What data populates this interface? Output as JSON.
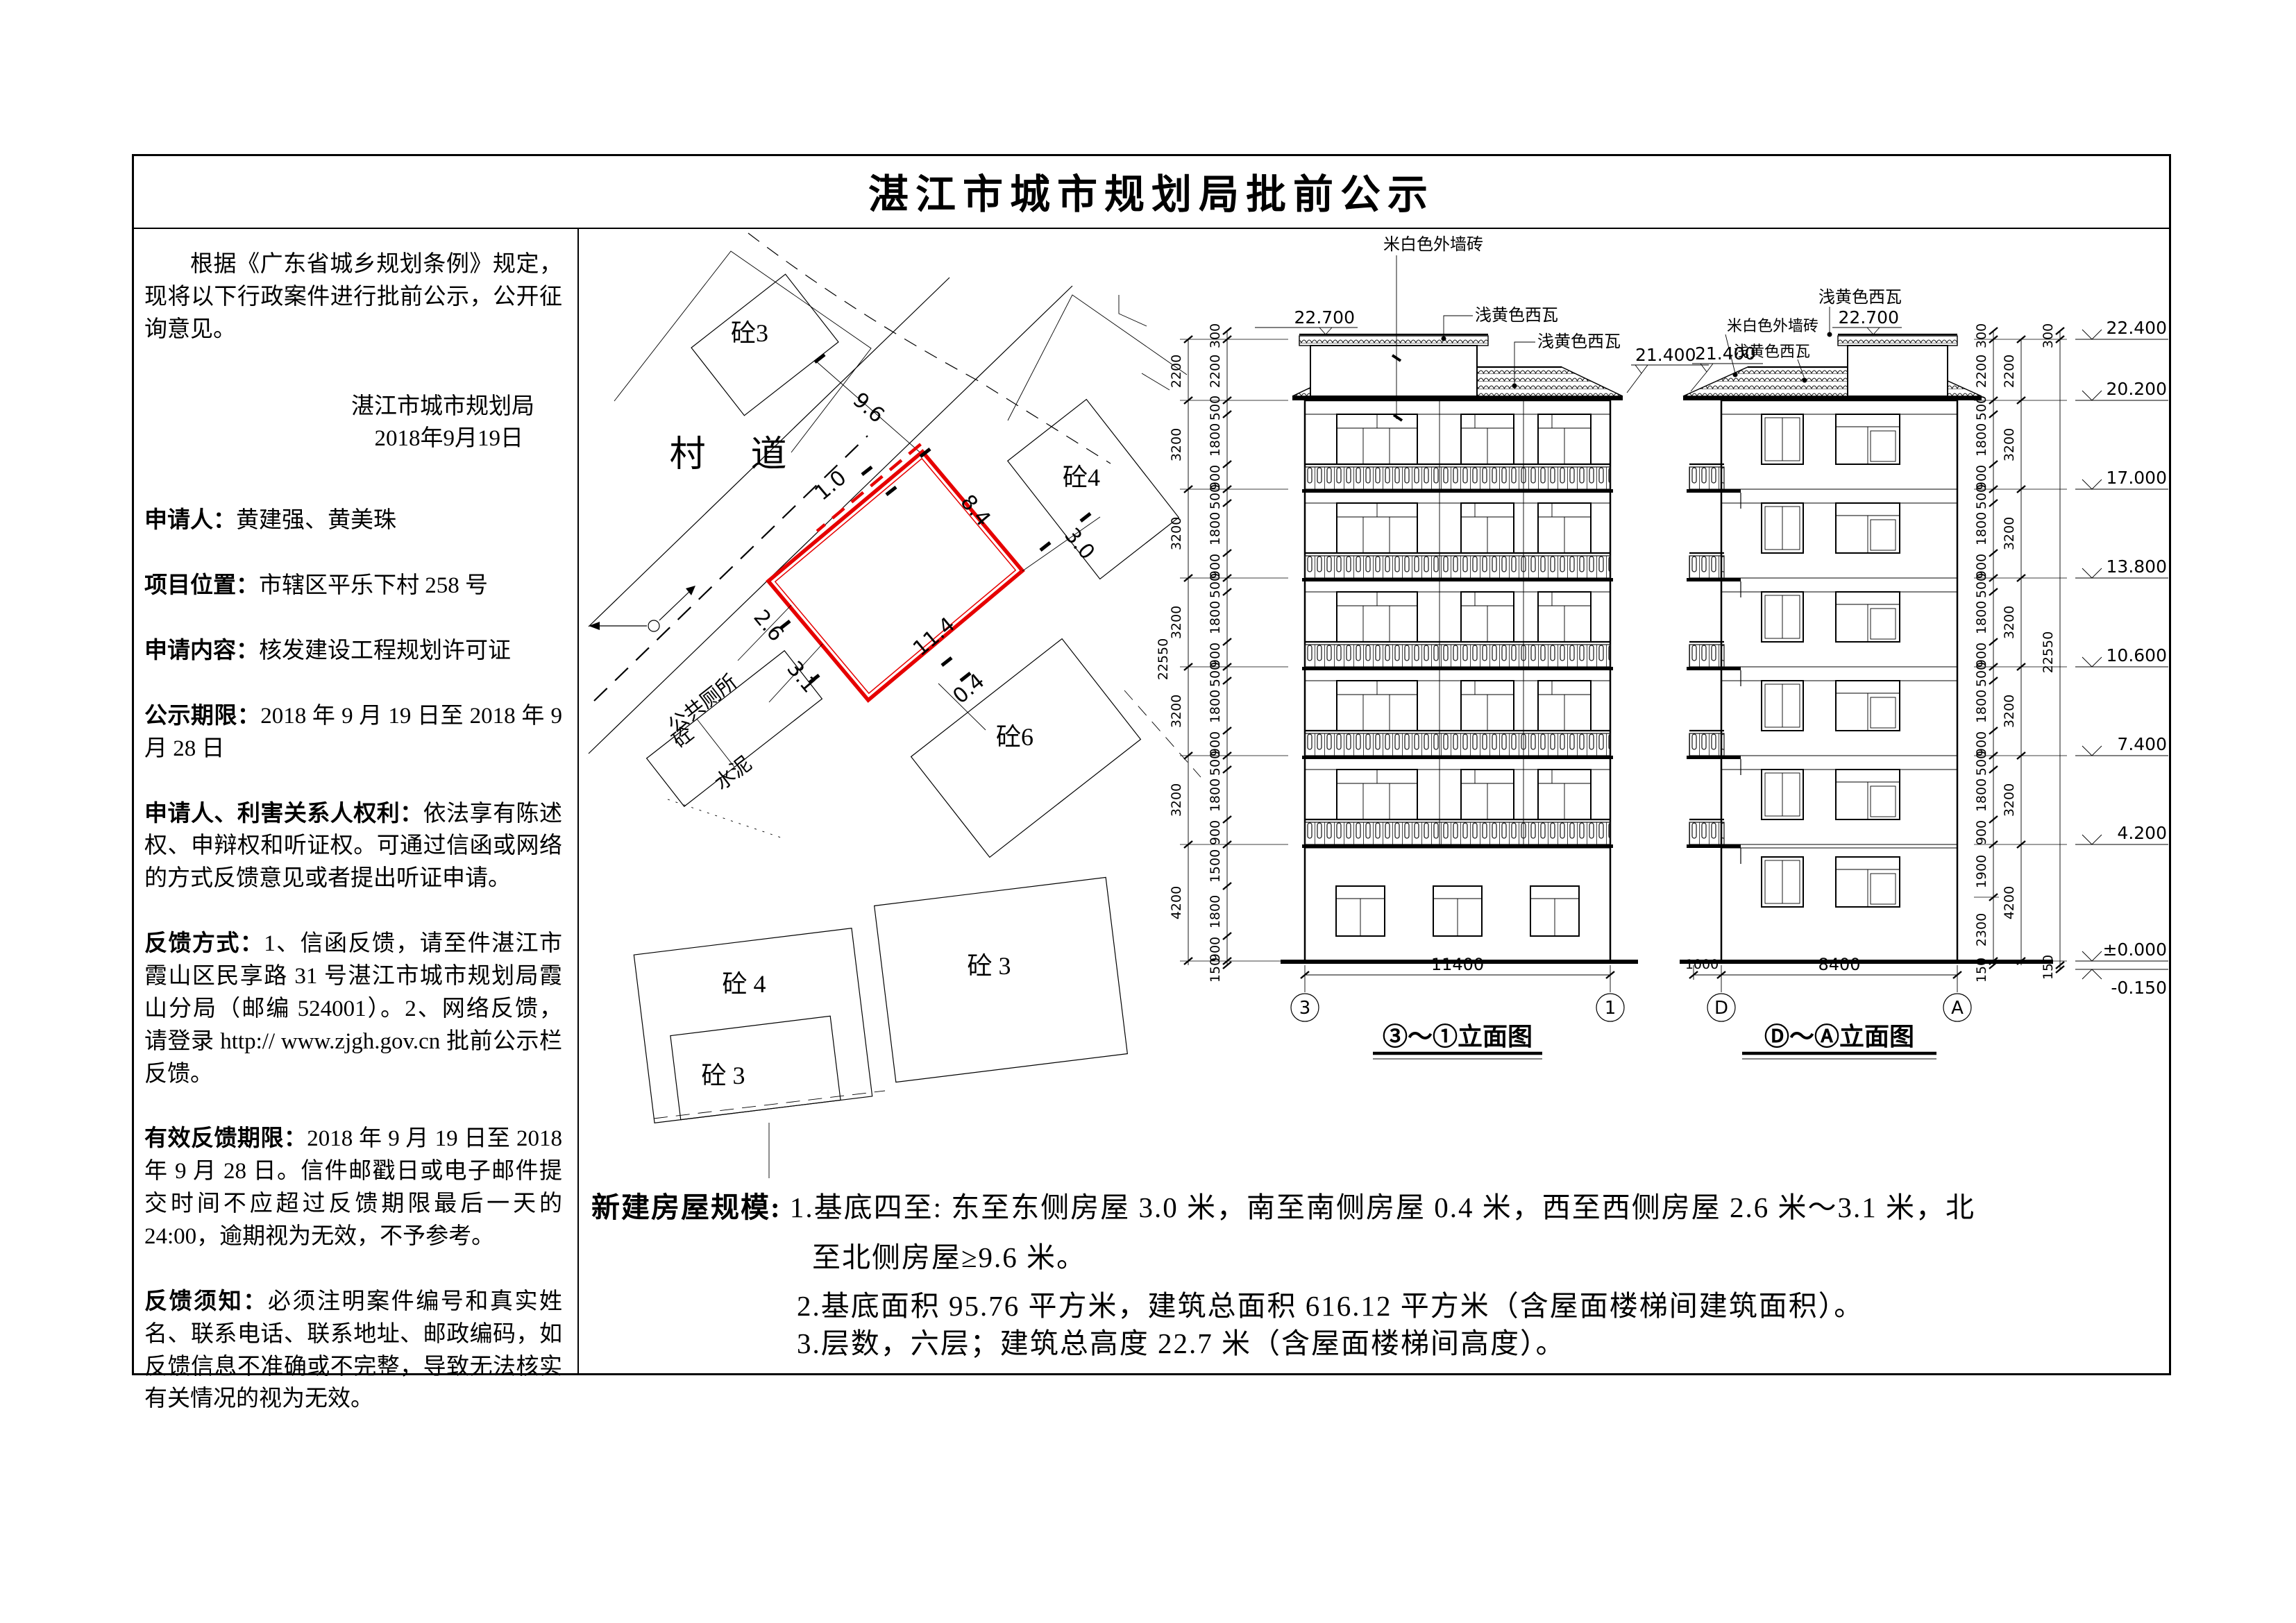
{
  "title": "湛江市城市规划局批前公示",
  "notice": {
    "intro": "根据《广东省城乡规划条例》规定，现将以下行政案件进行批前公示，公开征询意见。",
    "authority": "湛江市城市规划局",
    "date": "2018年9月19日",
    "fields": [
      {
        "label": "申请人：",
        "text": "黄建强、黄美珠"
      },
      {
        "label": "项目位置：",
        "text": "市辖区平乐下村 258 号"
      },
      {
        "label": "申请内容：",
        "text": "核发建设工程规划许可证"
      },
      {
        "label": "公示期限：",
        "text": "2018 年 9 月 19 日至 2018 年 9 月 28 日"
      },
      {
        "label": "申请人、利害关系人权利：",
        "text": "依法享有陈述权、申辩权和听证权。可通过信函或网络的方式反馈意见或者提出听证申请。"
      },
      {
        "label": "反馈方式：",
        "text": "1、信函反馈，请至件湛江市霞山区民享路 31 号湛江市城市规划局霞山分局（邮编 524001）。2、网络反馈，请登录 http:// www.zjgh.gov.cn 批前公示栏反馈。"
      },
      {
        "label": "有效反馈期限：",
        "text": "2018 年 9 月 19 日至 2018 年 9 月 28 日。信件邮戳日或电子邮件提交时间不应超过反馈期限最后一天的 24:00，逾期视为无效，不予参考。"
      },
      {
        "label": "反馈须知：",
        "text": "必须注明案件编号和真实姓名、联系电话、联系地址、邮政编码，如反馈信息不准确或不完整，导致无法核实有关情况的视为无效。"
      }
    ]
  },
  "site_plan": {
    "road": "村 道",
    "buildings": {
      "b3_top": "砼3",
      "b4_right": "砼4",
      "b6": "砼6",
      "toilet": "公共厕所",
      "toilet_mat": "砼",
      "cement": "水泥",
      "b4_bottom": "砼 4",
      "b3_nested": "砼 3",
      "b3_right": "砼 3"
    },
    "dims": {
      "north": "9.6",
      "frontage": "1.0",
      "east": "8.4",
      "west_min": "2.6",
      "west_max": "3.1",
      "south": "11.4",
      "south_gap": "0.4",
      "east_gap": "3.0"
    }
  },
  "elev_left": {
    "caption": "③～①立面图",
    "grid_a": "3",
    "grid_b": "1",
    "span": "11400",
    "level_top": "22.700",
    "level_ridge": "21.400",
    "note_wall": "米白色外墙砖",
    "note_tile1": "浅黄色西瓦",
    "note_tile2": "浅黄色西瓦",
    "total": "22550",
    "fine_dims": [
      "300",
      "2200",
      "500",
      "1800",
      "900",
      "500",
      "1800",
      "900",
      "500",
      "1800",
      "900",
      "500",
      "1800",
      "900",
      "500",
      "1800",
      "900",
      "1500",
      "1800",
      "900",
      "150"
    ],
    "group_dims": [
      "2200",
      "3200",
      "3200",
      "3200",
      "3200",
      "3200",
      "4200"
    ]
  },
  "elev_right": {
    "caption": "Ⓓ～Ⓐ立面图",
    "grid_a": "D",
    "grid_b": "A",
    "span": "8400",
    "offset": "1000",
    "level_top": "22.700",
    "level_ridge": "21.400",
    "note_tile1": "浅黄色西瓦",
    "note_wall": "米白色外墙砖",
    "note_tile2": "浅黄色西瓦",
    "fine_dims": [
      "300",
      "2200",
      "500",
      "1800",
      "900",
      "500",
      "1800",
      "900",
      "500",
      "1800",
      "900",
      "500",
      "1800",
      "900",
      "500",
      "1800",
      "900",
      "1900",
      "2300",
      "150"
    ],
    "group_dims": [
      "2200",
      "3200",
      "3200",
      "3200",
      "3200",
      "3200",
      "4200"
    ],
    "total_dims": [
      "300",
      "22550",
      "150"
    ],
    "markers": [
      "22.400",
      "20.200",
      "17.000",
      "13.800",
      "10.600",
      "7.400",
      "4.200",
      "±0.000",
      "-0.150"
    ]
  },
  "scale_note": {
    "label": "新建房屋规模:",
    "line1": "1.基底四至: 东至东侧房屋 3.0 米，南至南侧房屋 0.4 米，西至西侧房屋 2.6 米～3.1 米，北",
    "line2": "至北侧房屋≥9.6 米。",
    "line3": "2.基底面积 95.76 平方米，建筑总面积 616.12 平方米（含屋面楼梯间建筑面积）。",
    "line4": "3.层数，六层；建筑总高度 22.7 米（含屋面楼梯间高度）。"
  }
}
